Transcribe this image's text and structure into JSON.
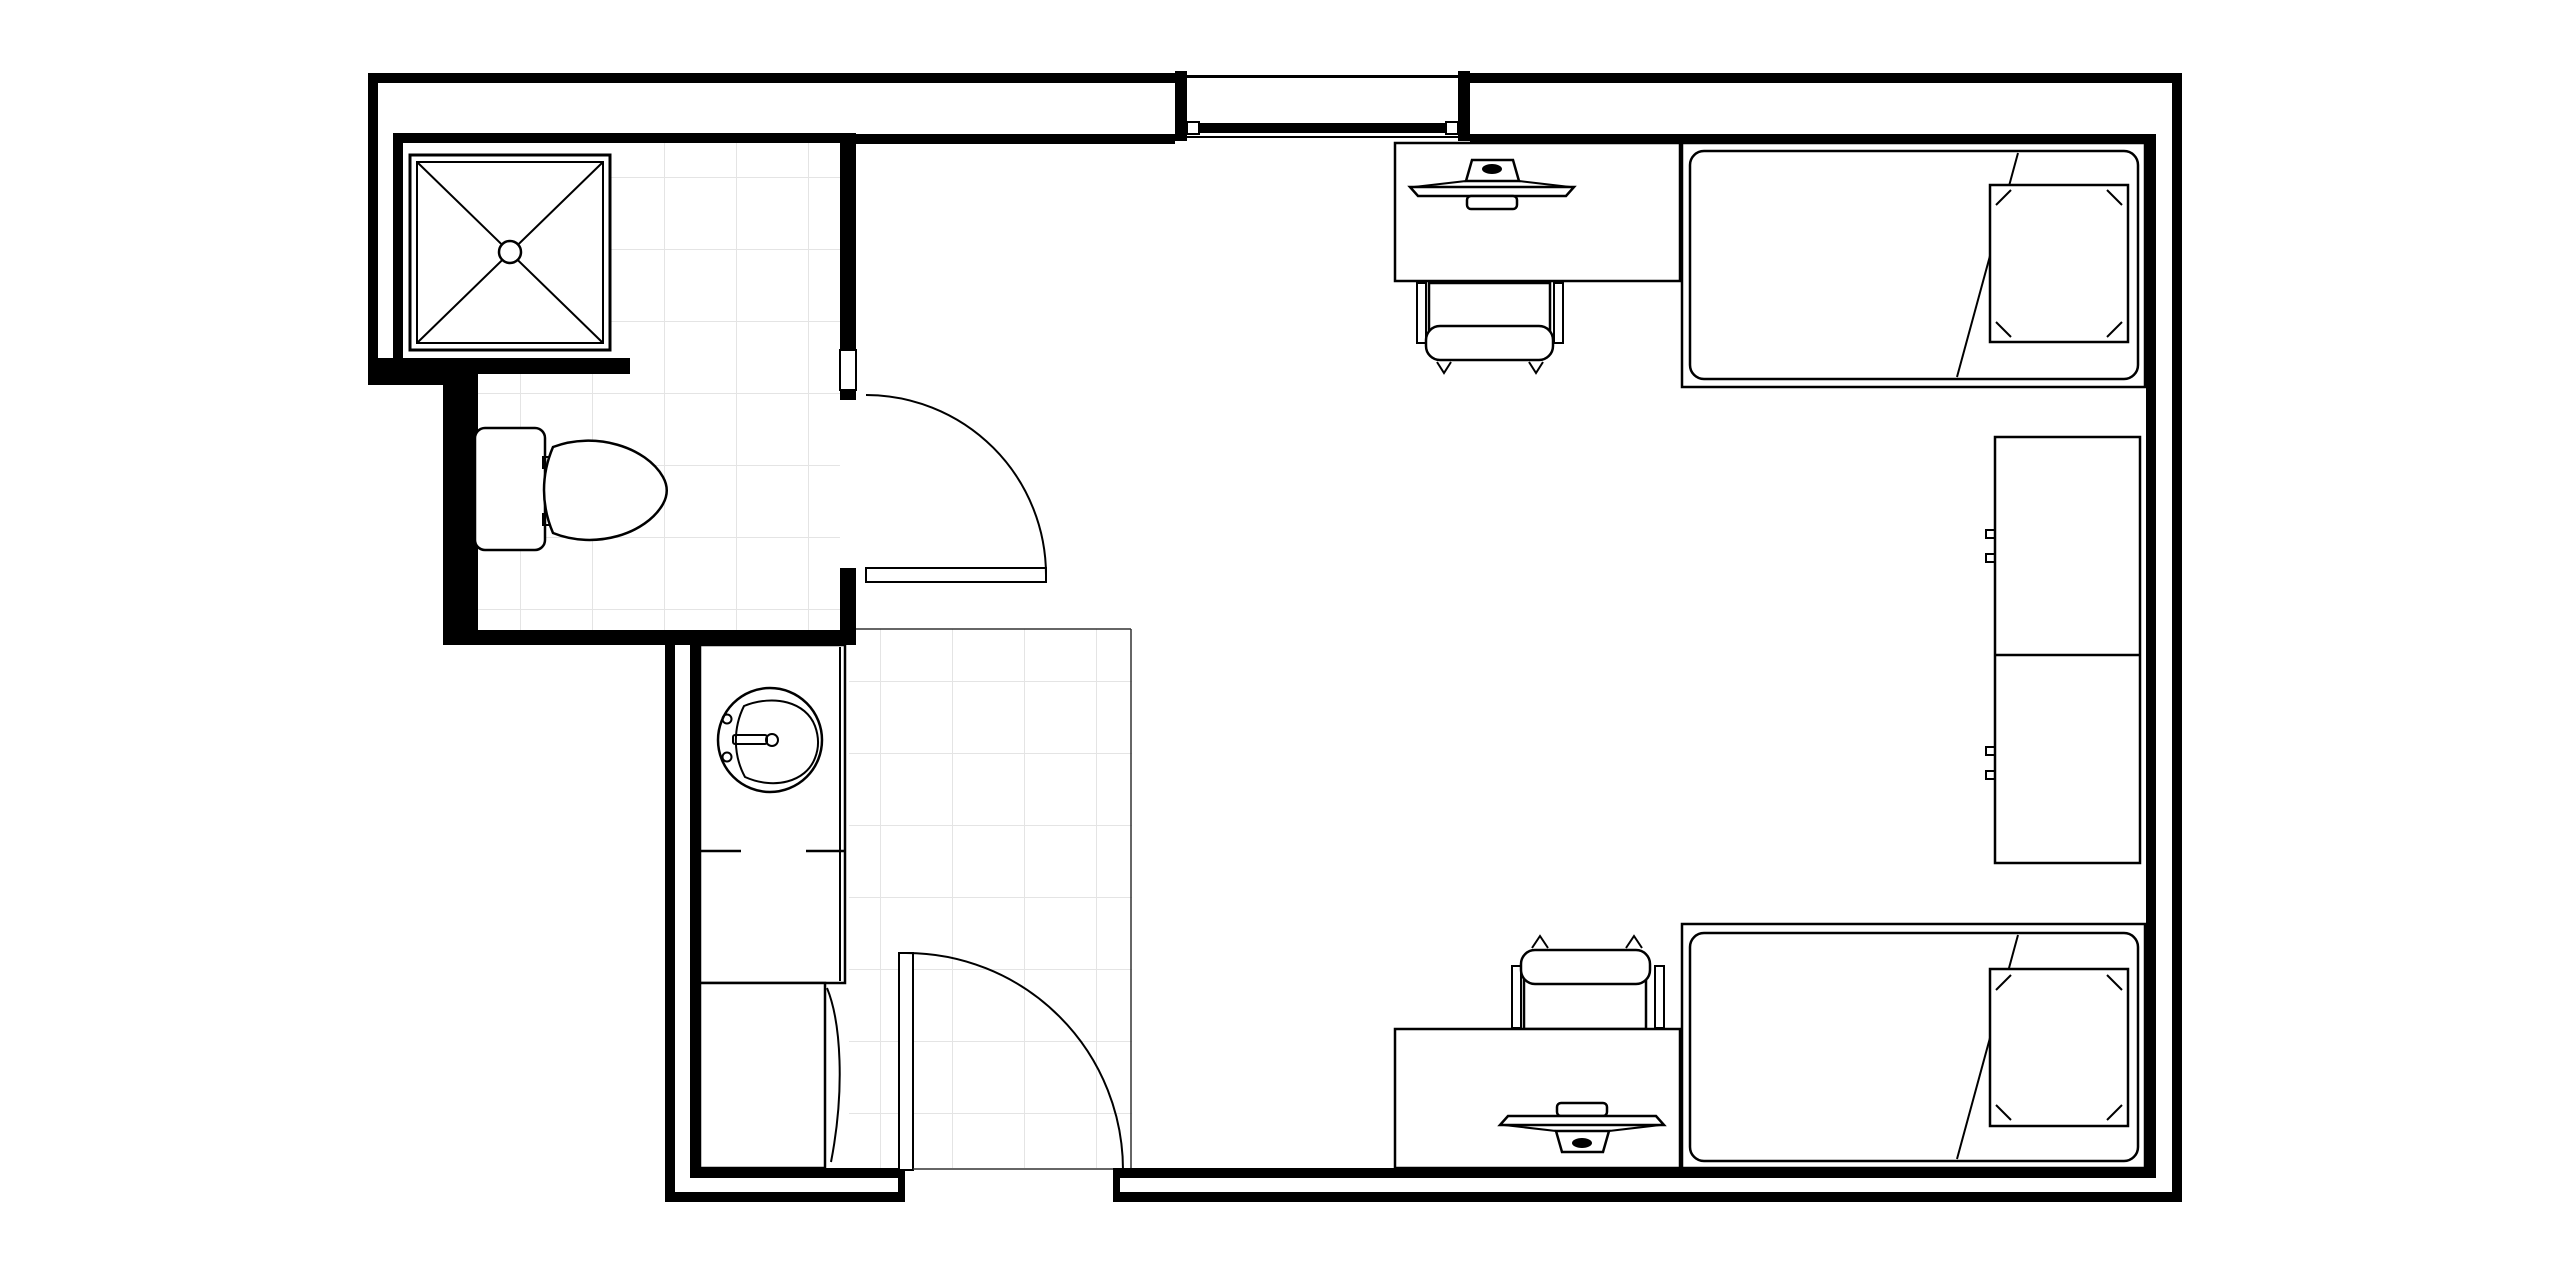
{
  "meta": {
    "title": "Dorm room floor plan with bathroom, entry vestibule, two beds, two desks and wardrobes",
    "diagram_type": "architectural-floor-plan",
    "drawing_style": "black line work on white, light gray tile grid in wet areas"
  },
  "canvas": {
    "width": 2550,
    "height": 1276,
    "viewbox": "0 0 2550 1276",
    "background": "#ffffff"
  },
  "colors": {
    "wall": "#000000",
    "line": "#000000",
    "floor": "#ffffff",
    "tile_grid": "#e4e4e4",
    "boundary": "#333333"
  },
  "rooms": [
    {
      "name": "bathroom",
      "floor_finish": "tile",
      "fixtures": [
        "shower",
        "toilet"
      ]
    },
    {
      "name": "entry-vestibule",
      "floor_finish": "tile",
      "fixtures": [
        "entry-door",
        "vanity-counter",
        "sink",
        "base-cabinet"
      ]
    },
    {
      "name": "bedroom",
      "floor_finish": "plain",
      "fixtures": [
        "window",
        "desk-1",
        "monitor-1",
        "chair-1",
        "bed-1",
        "pillow-1",
        "wardrobe",
        "bed-2",
        "pillow-2",
        "desk-2",
        "monitor-2",
        "chair-2"
      ]
    }
  ],
  "fixtures": [
    {
      "name": "shower",
      "bbox": [
        410,
        155,
        200,
        195
      ],
      "symbol": "square with X diagonals and center drain circle"
    },
    {
      "name": "toilet",
      "bbox": [
        475,
        428,
        193,
        122
      ],
      "symbol": "tank against west wall, bowl pointing east"
    },
    {
      "name": "vanity-counter",
      "bbox": [
        700,
        645,
        145,
        338
      ],
      "symbol": "counter with round lavatory sink and faucet"
    },
    {
      "name": "base-cabinet",
      "bbox": [
        700,
        983,
        125,
        185
      ],
      "symbol": "cabinet with curved front line"
    },
    {
      "name": "window",
      "bbox": [
        1175,
        71,
        295,
        70
      ],
      "symbol": "opening in north wall with sill and jamb blocks"
    },
    {
      "name": "desk-1",
      "bbox": [
        1395,
        143,
        285,
        138
      ],
      "monitor_center_x": 1492
    },
    {
      "name": "chair-1",
      "bbox": [
        1417,
        281,
        146,
        92
      ]
    },
    {
      "name": "bed-1",
      "bbox": [
        1682,
        143,
        463,
        244
      ],
      "pillow_bbox": [
        1990,
        185,
        138,
        157
      ]
    },
    {
      "name": "wardrobe",
      "bbox": [
        1995,
        437,
        145,
        426
      ],
      "units": 2,
      "handles_per_unit": 2
    },
    {
      "name": "bed-2",
      "bbox": [
        1682,
        924,
        463,
        244
      ],
      "pillow_bbox": [
        1990,
        969,
        138,
        157
      ]
    },
    {
      "name": "desk-2",
      "bbox": [
        1395,
        1029,
        285,
        139
      ],
      "monitor_center_x": 1582
    },
    {
      "name": "chair-2",
      "bbox": [
        1512,
        938,
        151,
        91
      ]
    }
  ],
  "doors": [
    {
      "name": "bathroom-door",
      "hinge": [
        866,
        575
      ],
      "swing": "quarter arc into bedroom, leaf open to east"
    },
    {
      "name": "entry-door",
      "hinge": [
        906,
        1170
      ],
      "swing": "quarter arc into vestibule, leaf open to north"
    }
  ],
  "walls": {
    "construction": "double-line: thick exterior shell with inner furring walls and hollow gaps",
    "exterior_thickness_px": 10,
    "interior_thickness_px": 10
  }
}
